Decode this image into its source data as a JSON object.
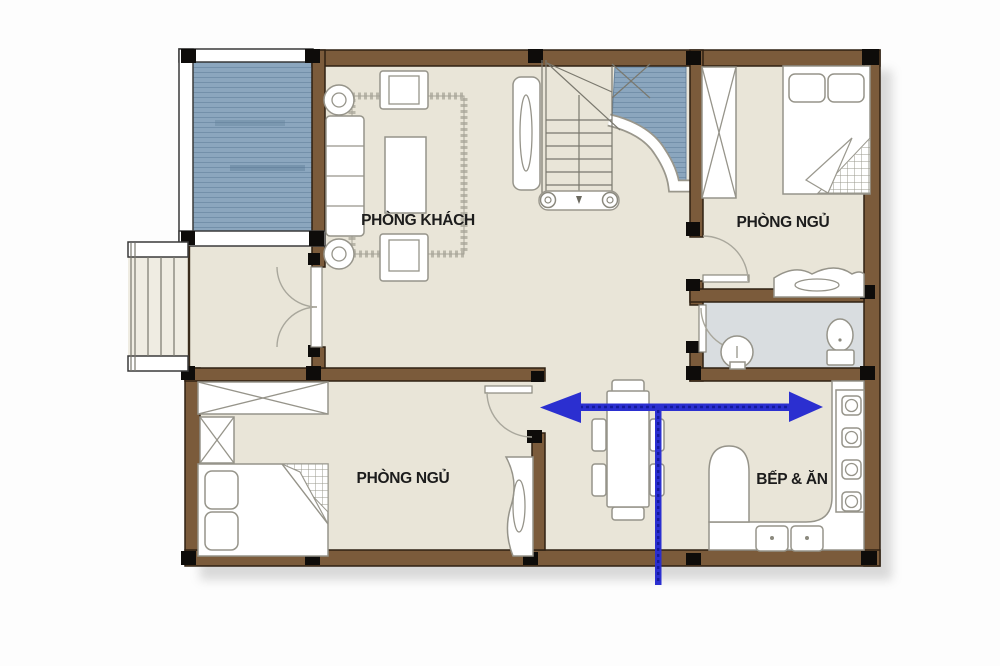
{
  "plan": {
    "type": "residential-floor-plan",
    "rooms": {
      "living_room": {
        "label": "PHÒNG KHÁCH"
      },
      "bedroom_top_right": {
        "label": "PHÒNG NGỦ"
      },
      "bedroom_bottom_left": {
        "label": "PHÒNG NGỦ"
      },
      "kitchen_dining": {
        "label": "BẾP & ĂN"
      }
    },
    "annotation": {
      "arrow_shape": "double-headed horizontal arrow with vertical drop line",
      "arrow_color": "#2b2fd0"
    }
  },
  "colors": {
    "wall": "#7b5b3b",
    "wall-outline": "#2f2113",
    "floor": "#e9e5d8",
    "deck": "#8ba6be",
    "deck-line": "#5f7d99",
    "bath-floor": "#d9dde0",
    "furniture-outline": "#96948a",
    "column": "#0e0c0a",
    "thin-wall": "#ffffff",
    "stair-line": "#7a786e",
    "arrow": "#2b2fd0",
    "arrow-dash": "#141a9e",
    "label": "#1c1c1c"
  }
}
